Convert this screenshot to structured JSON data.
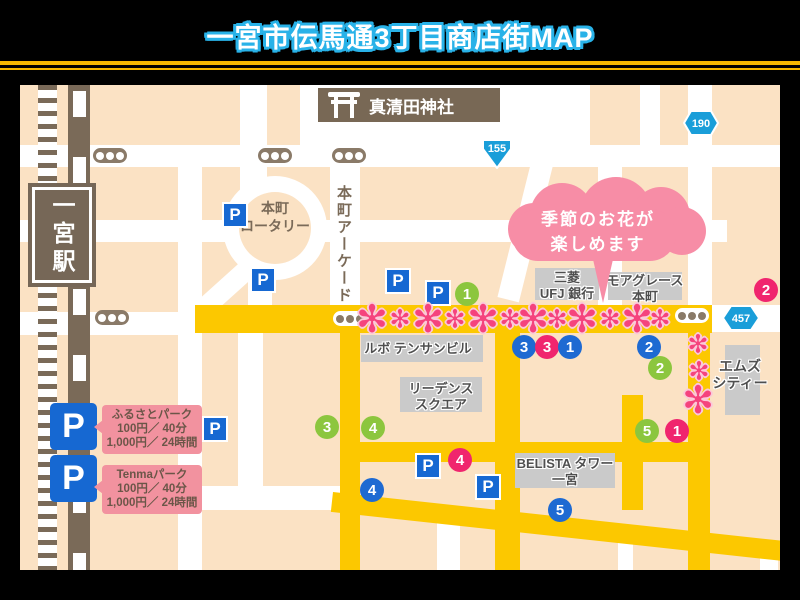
{
  "title": "一宮市伝馬通3丁目商店街MAP",
  "station": "一宮駅",
  "shrine": "真清田神社",
  "roundabout": "本町\nロータリー",
  "arcade": "本町アーケード",
  "bubble": {
    "line1": "季節のお花が",
    "line2": "楽しめます"
  },
  "routes": {
    "r155": "155",
    "r190": "190",
    "r457": "457"
  },
  "buildings": {
    "ufj": "三菱\nUFJ 銀行",
    "moa_grace": "モアグレース\n本町",
    "lubo": "ルボ テンサンビル",
    "leadence": "リーデンス\nスクエア",
    "belista": "BELISTA タワー\n一宮",
    "ms_city": "エムズ\nシティー"
  },
  "parking": {
    "icon": "P",
    "legend": [
      {
        "name": "ふるさとパーク",
        "rate": "100円／ 40分",
        "day_rate": "1,000円／ 24時間"
      },
      {
        "name": "Tenmaパーク",
        "rate": "100円／ 40分",
        "day_rate": "1,000円／ 24時間"
      }
    ]
  },
  "markers": [
    {
      "number": "1",
      "color": "green"
    },
    {
      "number": "3",
      "color": "blue"
    },
    {
      "number": "3",
      "color": "pink"
    },
    {
      "number": "1",
      "color": "blue"
    },
    {
      "number": "2",
      "color": "blue"
    },
    {
      "number": "2",
      "color": "pink"
    },
    {
      "number": "2",
      "color": "green"
    },
    {
      "number": "3",
      "color": "green"
    },
    {
      "number": "4",
      "color": "green"
    },
    {
      "number": "5",
      "color": "green"
    },
    {
      "number": "1",
      "color": "pink"
    },
    {
      "number": "4",
      "color": "blue"
    },
    {
      "number": "4",
      "color": "pink"
    },
    {
      "number": "5",
      "color": "blue"
    }
  ],
  "flower": {
    "glyph": "✻"
  },
  "colors": {
    "map_bg": "#fbe2c4",
    "road_highlight": "#fcc800",
    "rail_brown": "#7a6a58",
    "marker_blue": "#1e6ad2",
    "marker_green": "#8cc63e",
    "marker_pink": "#f0256e",
    "flower_pink": "#f5437d",
    "bubble_pink": "#f78da6",
    "legend_pink": "#f2929f",
    "badge_blue": "#1a9ed9",
    "title_outline": "#29b2e8",
    "header_line_yellow": "#f5b800"
  }
}
